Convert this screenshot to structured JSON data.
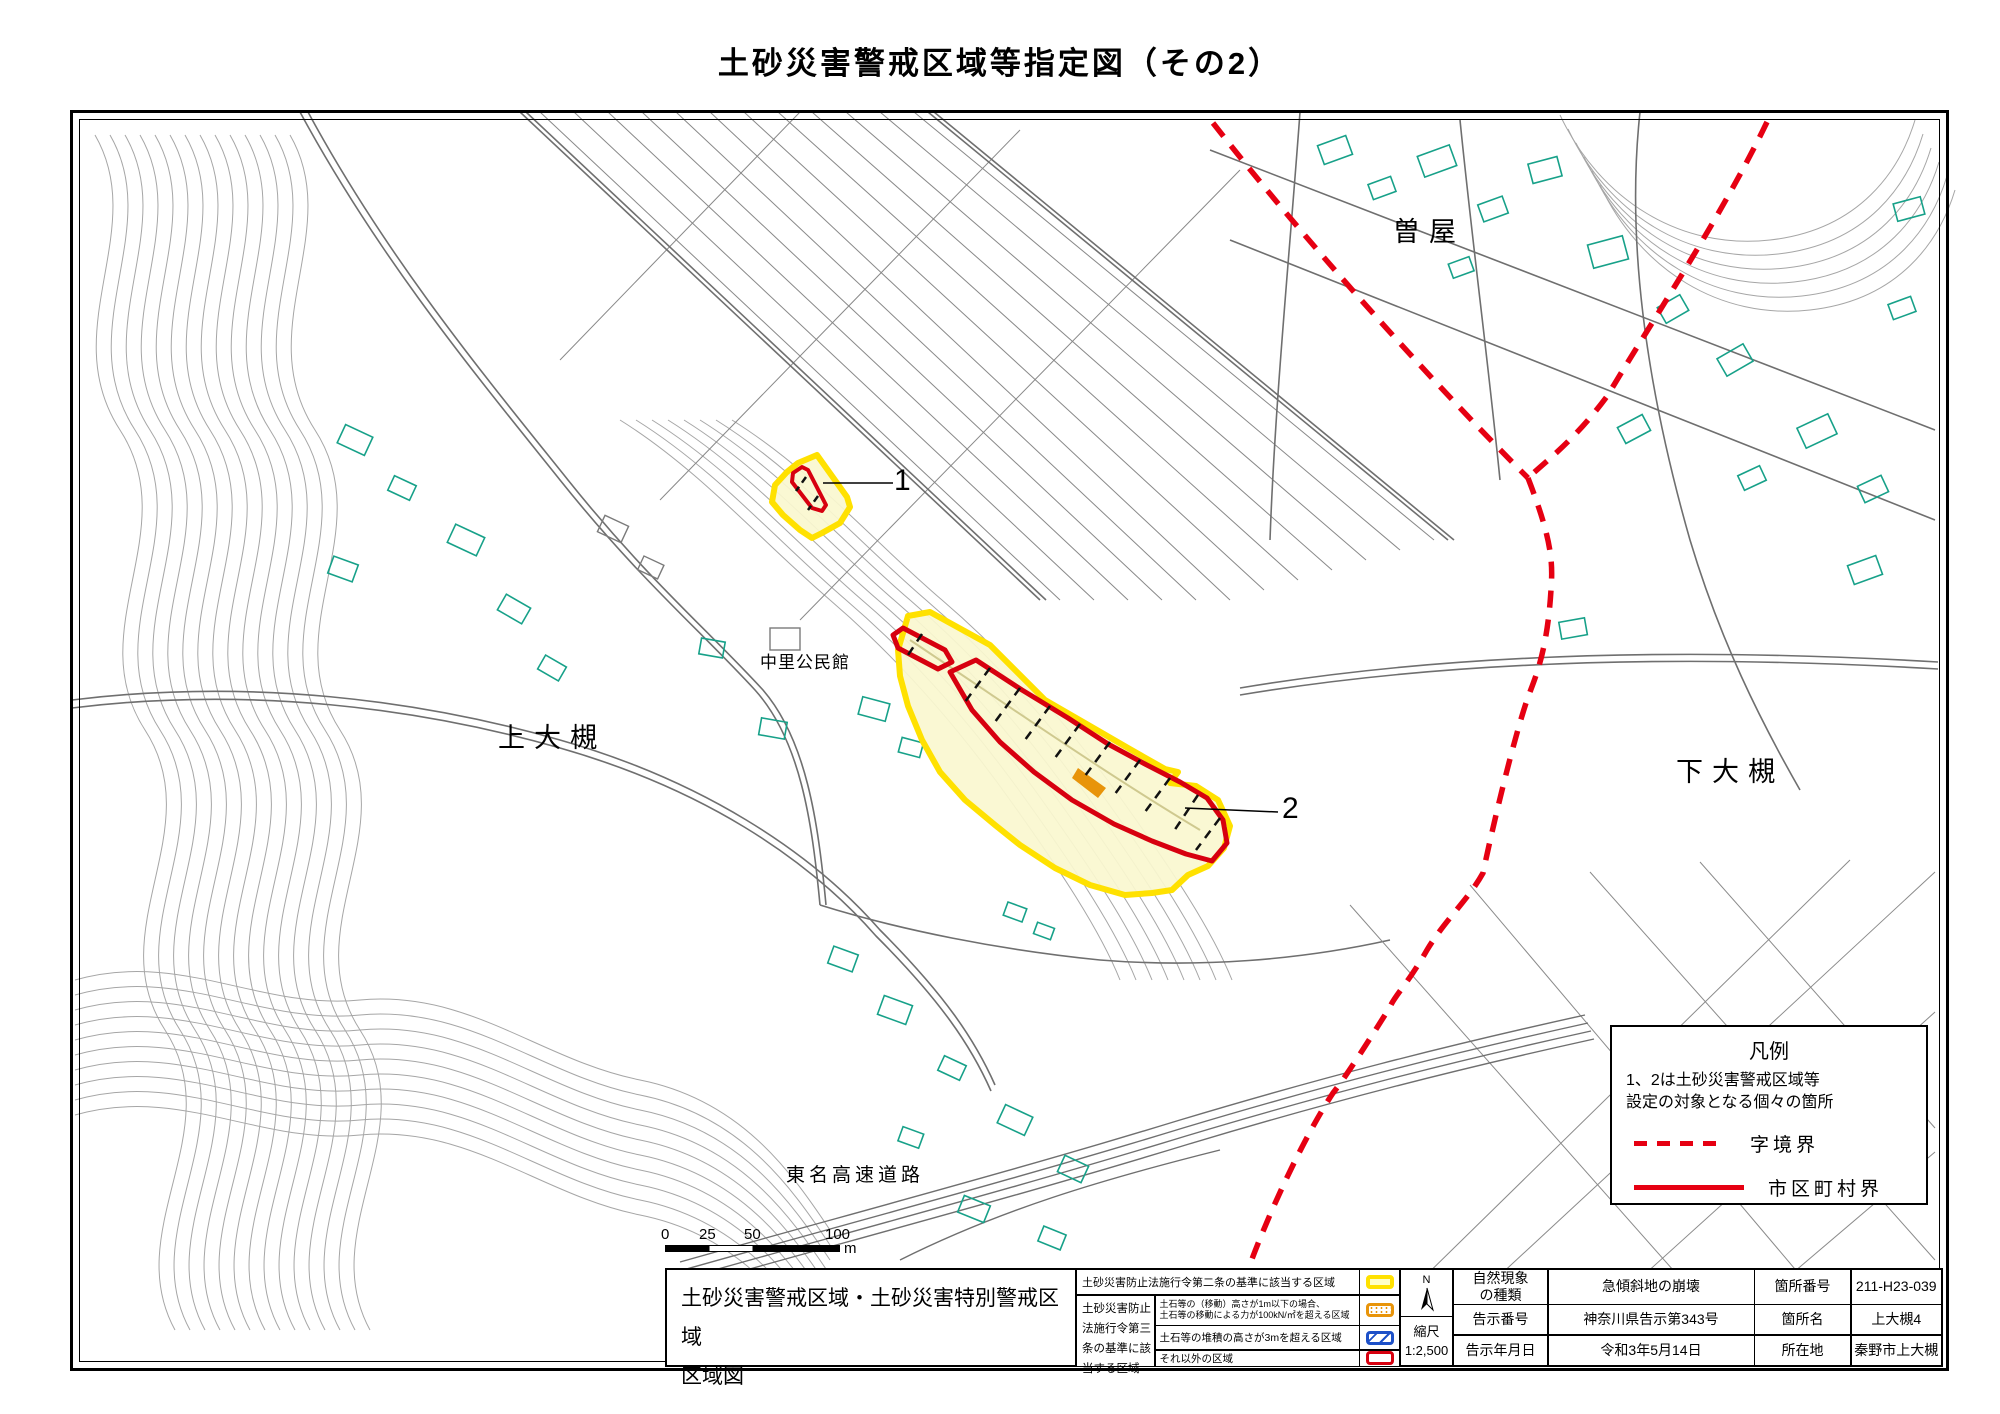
{
  "title": "土砂災害警戒区域等指定図（その2）",
  "map": {
    "labels": {
      "soya": "曽屋",
      "kami_ootsuki": "上大槻",
      "shimo_ootsuki": "下大槻",
      "nakazato_hall": "中里公民館",
      "tomei_expressway": "東名高速道路"
    },
    "zone_markers": {
      "zone1": "1",
      "zone2": "2"
    }
  },
  "legend_box": {
    "title": "凡例",
    "note_line1": "1、2は土砂災害警戒区域等",
    "note_line2": "設定の対象となる個々の箇所",
    "dashed_label": "字境界",
    "solid_label": "市区町村界"
  },
  "scale_bar": {
    "ticks": [
      "0",
      "25",
      "50",
      "100"
    ],
    "unit": "m"
  },
  "info_table": {
    "map_title_line1": "土砂災害警戒区域・土砂災害特別警戒区域",
    "map_title_line2": "区域図",
    "legend_rows": {
      "row1": "土砂災害防止法施行令第二条の基準に該当する区域",
      "article3_label": "土砂災害防止法施行令第三条の基準に該当する区域",
      "row2_line1": "土石等の（移動）高さが1m以下の場合、",
      "row2_line2": "土石等の移動による力が100kN/㎡を超える区域",
      "row3": "土石等の堆積の高さが3mを超える区域",
      "row4": "それ以外の区域"
    },
    "compass": {
      "north": "N",
      "scale_label": "縮尺",
      "scale_value": "1:2,500"
    },
    "meta": {
      "r1c1a": "自然現象",
      "r1c1b": "の種類",
      "r1c2": "急傾斜地の崩壊",
      "r1c3": "箇所番号",
      "r1c4": "211-H23-039",
      "r2c1": "告示番号",
      "r2c2": "神奈川県告示第343号",
      "r2c3": "箇所名",
      "r2c4": "上大槻4",
      "r3c1": "告示年月日",
      "r3c2": "令和3年5月14日",
      "r3c3": "所在地",
      "r3c4": "秦野市上大槻"
    }
  },
  "colors": {
    "warning_zone_yellow_border": "#ffe100",
    "warning_zone_yellow_fill": "#faf7cf",
    "special_zone_red": "#d7000f",
    "special_orange": "#e8940a",
    "deposit_blue": "#1d50c8",
    "boundary_red": "#e60012",
    "building_teal": "#17a189",
    "contour_gray": "#a0a0a0"
  }
}
